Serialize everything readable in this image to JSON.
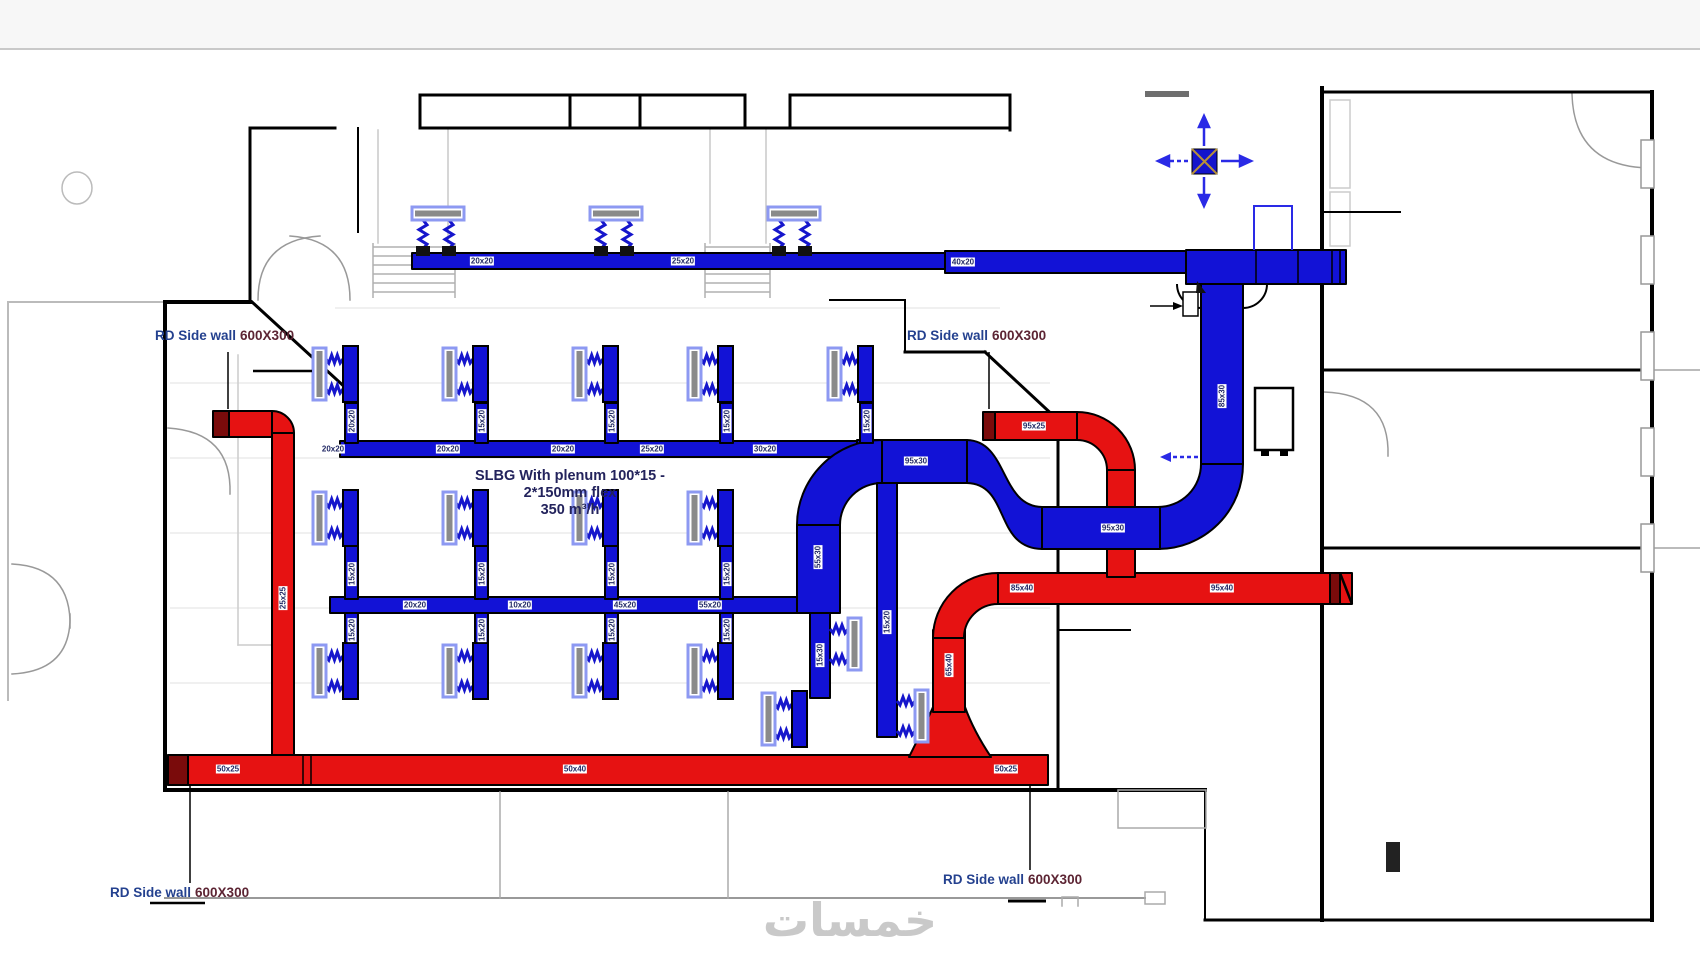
{
  "page": {
    "band_color": "#f7f7f7",
    "background": "#ffffff"
  },
  "colors": {
    "supply_duct": "#1212d6",
    "return_duct": "#e61212",
    "grille_dark": "#7a0b0b",
    "diffuser_outline": "#8d99f2",
    "flex_zigzag": "#1616cc",
    "wall": "#000000",
    "label_text": "#232a66",
    "watermark_gray": "#c9c9c9",
    "symbol_blue": "#2a2ae6"
  },
  "annotations": {
    "rd_side_wall_labels": [
      {
        "prefix": "RD Side wall",
        "size": "600X300",
        "x": 155,
        "y": 328
      },
      {
        "prefix": "RD Side wall",
        "size": "600X300",
        "x": 907,
        "y": 328
      },
      {
        "prefix": "RD Side wall",
        "size": "600X300",
        "x": 110,
        "y": 885
      },
      {
        "prefix": "RD Side wall",
        "size": "600X300",
        "x": 943,
        "y": 872
      }
    ],
    "slbg_note": {
      "lines": [
        "SLBG With plenum 100*15 -",
        "2*150mm flex",
        "350 m³/h"
      ]
    },
    "watermark": "خمسات"
  },
  "duct_labels": [
    {
      "t": "20x20",
      "x": 482,
      "y": 261,
      "r": 0
    },
    {
      "t": "25x20",
      "x": 683,
      "y": 261,
      "r": 0
    },
    {
      "t": "40x20",
      "x": 963,
      "y": 262,
      "r": 0
    },
    {
      "t": "85x30",
      "x": 1222,
      "y": 396,
      "r": 1
    },
    {
      "t": "95x30",
      "x": 1113,
      "y": 528,
      "r": 0
    },
    {
      "t": "95x30",
      "x": 916,
      "y": 461,
      "r": 0
    },
    {
      "t": "20x20",
      "x": 333,
      "y": 449,
      "r": 0
    },
    {
      "t": "20x20",
      "x": 448,
      "y": 449,
      "r": 0
    },
    {
      "t": "20x20",
      "x": 563,
      "y": 449,
      "r": 0
    },
    {
      "t": "25x20",
      "x": 652,
      "y": 449,
      "r": 0
    },
    {
      "t": "30x20",
      "x": 765,
      "y": 449,
      "r": 0
    },
    {
      "t": "20x20",
      "x": 352,
      "y": 421,
      "r": 1
    },
    {
      "t": "15x20",
      "x": 482,
      "y": 421,
      "r": 1
    },
    {
      "t": "15x20",
      "x": 612,
      "y": 421,
      "r": 1
    },
    {
      "t": "15x20",
      "x": 727,
      "y": 421,
      "r": 1
    },
    {
      "t": "15x20",
      "x": 867,
      "y": 421,
      "r": 1
    },
    {
      "t": "15x20",
      "x": 352,
      "y": 574,
      "r": 1
    },
    {
      "t": "15x20",
      "x": 482,
      "y": 574,
      "r": 1
    },
    {
      "t": "15x20",
      "x": 612,
      "y": 574,
      "r": 1
    },
    {
      "t": "15x20",
      "x": 727,
      "y": 574,
      "r": 1
    },
    {
      "t": "15x20",
      "x": 352,
      "y": 630,
      "r": 1
    },
    {
      "t": "15x20",
      "x": 482,
      "y": 630,
      "r": 1
    },
    {
      "t": "15x20",
      "x": 612,
      "y": 630,
      "r": 1
    },
    {
      "t": "15x20",
      "x": 727,
      "y": 630,
      "r": 1
    },
    {
      "t": "20x20",
      "x": 415,
      "y": 605,
      "r": 0
    },
    {
      "t": "10x20",
      "x": 520,
      "y": 605,
      "r": 0
    },
    {
      "t": "45x20",
      "x": 625,
      "y": 605,
      "r": 0
    },
    {
      "t": "55x20",
      "x": 710,
      "y": 605,
      "r": 0
    },
    {
      "t": "55x30",
      "x": 818,
      "y": 557,
      "r": 1
    },
    {
      "t": "15x30",
      "x": 820,
      "y": 655,
      "r": 1
    },
    {
      "t": "15x20",
      "x": 887,
      "y": 622,
      "r": 1
    },
    {
      "t": "25x25",
      "x": 283,
      "y": 598,
      "r": 1
    },
    {
      "t": "50x25",
      "x": 228,
      "y": 769,
      "r": 0
    },
    {
      "t": "50x40",
      "x": 575,
      "y": 769,
      "r": 0
    },
    {
      "t": "50x25",
      "x": 1006,
      "y": 769,
      "r": 0
    },
    {
      "t": "65x40",
      "x": 949,
      "y": 665,
      "r": 1
    },
    {
      "t": "85x40",
      "x": 1022,
      "y": 588,
      "r": 0
    },
    {
      "t": "95x40",
      "x": 1222,
      "y": 588,
      "r": 0
    },
    {
      "t": "95x25",
      "x": 1034,
      "y": 426,
      "r": 0
    }
  ],
  "diffusers": [
    {
      "o": "down",
      "x": 412,
      "y": 207
    },
    {
      "o": "down",
      "x": 590,
      "y": 207
    },
    {
      "o": "down",
      "x": 768,
      "y": 207
    },
    {
      "o": "right",
      "x": 313,
      "y": 348
    },
    {
      "o": "right",
      "x": 443,
      "y": 348
    },
    {
      "o": "right",
      "x": 573,
      "y": 348
    },
    {
      "o": "right",
      "x": 688,
      "y": 348
    },
    {
      "o": "right",
      "x": 828,
      "y": 348
    },
    {
      "o": "right",
      "x": 313,
      "y": 492
    },
    {
      "o": "right",
      "x": 443,
      "y": 492
    },
    {
      "o": "right",
      "x": 573,
      "y": 492
    },
    {
      "o": "right",
      "x": 688,
      "y": 492
    },
    {
      "o": "right",
      "x": 313,
      "y": 645
    },
    {
      "o": "right",
      "x": 443,
      "y": 645
    },
    {
      "o": "right",
      "x": 573,
      "y": 645
    },
    {
      "o": "right",
      "x": 688,
      "y": 645
    },
    {
      "o": "right",
      "x": 762,
      "y": 693
    },
    {
      "o": "left",
      "x": 830,
      "y": 618
    },
    {
      "o": "left",
      "x": 897,
      "y": 690
    }
  ]
}
